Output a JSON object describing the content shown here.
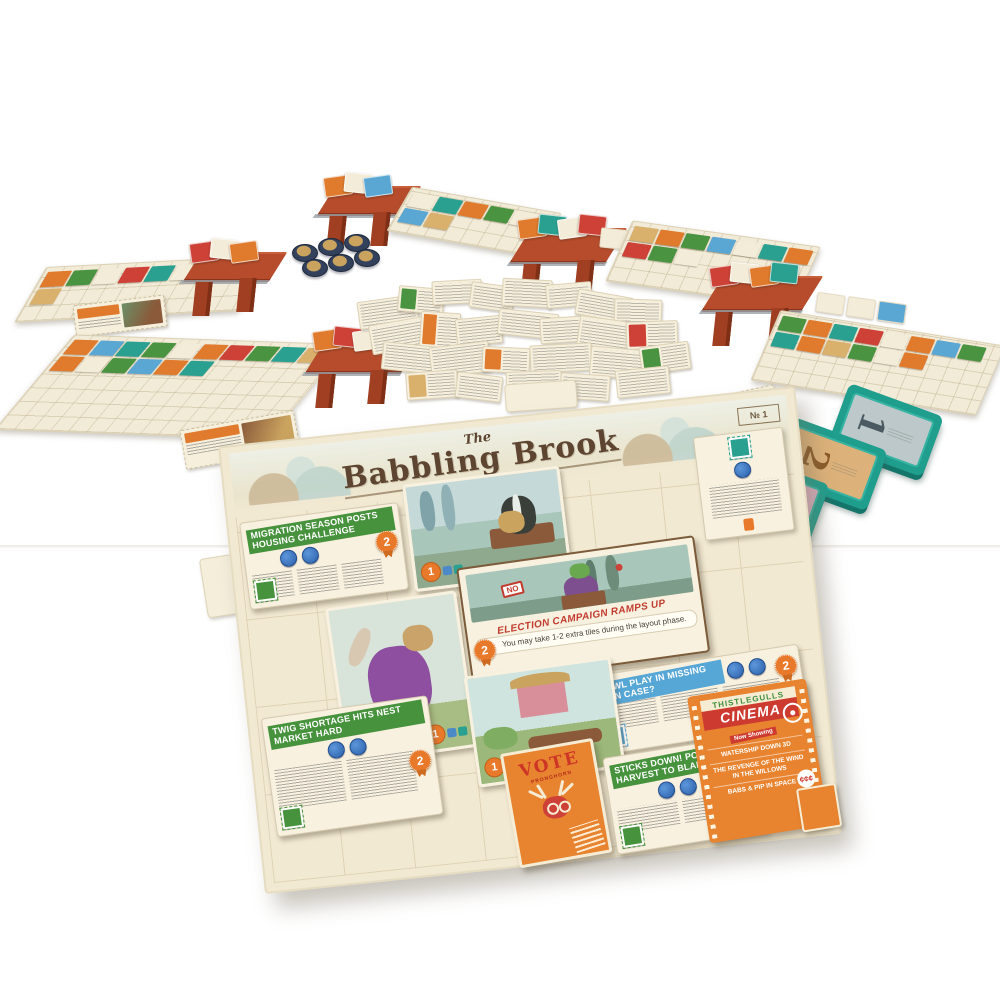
{
  "scene": {
    "description": "Product photo of the Fit to Print style newspaper board game set up on a white table",
    "board_title": "The Babbling Brook"
  },
  "palette": {
    "colors": [
      "#e07b2e",
      "#4a9340",
      "#2aa090",
      "#5aa7d4",
      "#cd4136",
      "#d9b06c",
      "#f3ecd8",
      "#8e5aa0"
    ]
  },
  "masthead": {
    "the": "The",
    "title": "Babbling Brook",
    "issue_label": "№ 1"
  },
  "central_board": {
    "headlines": [
      {
        "text": "MIGRATION SEASON POSTS HOUSING CHALLENGE",
        "color": "green"
      },
      {
        "text": "FOWL PLAY IN MISSING HEN CASE?",
        "color": "blue"
      },
      {
        "text": "TWIG SHORTAGE HITS NEST MARKET HARD",
        "color": "green"
      },
      {
        "text": "STICKS DOWN! POOR HARVEST TO BLAME",
        "color": "green"
      }
    ],
    "event_card": {
      "banner": "ELECTION CAMPAIGN RAMPS UP",
      "body": "You may take 1-2 extra tiles during the layout phase.",
      "sign_text": "NO",
      "badge": "2"
    },
    "cinema_card": {
      "venue": "THISTLEGULLS",
      "title": "CINEMA",
      "banner": "Now Showing",
      "listings": [
        "WATERSHIP DOWN 3D",
        "THE REVENGE OF THE WIND IN THE WILLOWS",
        "BABS & PIP IN SPACE"
      ],
      "cost": "¢¢¢"
    },
    "vote_card": {
      "title": "VOTE",
      "subtitle": "PRONGHORN"
    },
    "rosette_value": "2",
    "photo_badge_value": "1"
  },
  "tiles": {
    "items": [
      {
        "number": "1",
        "face": "#bcc8c9",
        "ink": "#4a5a60"
      },
      {
        "number": "2",
        "face": "#ddb27a",
        "ink": "#8a5a28"
      },
      {
        "number": "3",
        "face": "#d9b0c0",
        "ink": "#7d4f63"
      }
    ]
  },
  "tokens": {
    "positions": [
      [
        8,
        12
      ],
      [
        34,
        6
      ],
      [
        60,
        2
      ],
      [
        18,
        27
      ],
      [
        44,
        22
      ],
      [
        70,
        17
      ]
    ]
  },
  "player_areas": {
    "top_left_board": [
      0,
      1,
      6,
      4,
      2,
      6,
      1,
      0,
      5
    ],
    "left_board": [
      0,
      3,
      2,
      1,
      6,
      0,
      4,
      1,
      2,
      5,
      0,
      6,
      1,
      3,
      0,
      2
    ],
    "top_center_board": [
      6,
      2,
      0,
      1,
      6,
      3,
      5
    ],
    "right_top_board": [
      5,
      0,
      1,
      3,
      6,
      2,
      0,
      4,
      1,
      6
    ],
    "right_bottom_board": [
      1,
      0,
      2,
      4,
      6,
      0,
      3,
      1,
      2,
      0,
      5,
      1,
      6,
      0
    ],
    "heap_top_left": [
      4,
      6,
      0
    ],
    "heap_top_center_a": [
      0,
      6,
      3
    ],
    "heap_top_center_b": [
      0,
      2,
      6,
      4
    ],
    "heap_left": [
      0,
      4,
      6,
      1
    ],
    "heap_right": [
      4,
      6,
      0,
      2
    ],
    "row_right_of_stand_b": [
      6,
      5,
      6
    ],
    "row_right_of_right_stand": [
      6,
      6,
      3
    ]
  },
  "scatter": {
    "cards": [
      {
        "x": 358,
        "y": 298,
        "w": 54,
        "h": 22,
        "r": -8
      },
      {
        "x": 398,
        "y": 287,
        "w": 40,
        "h": 20,
        "r": 5,
        "a": 1
      },
      {
        "x": 432,
        "y": 280,
        "w": 44,
        "h": 18,
        "r": -3
      },
      {
        "x": 470,
        "y": 284,
        "w": 38,
        "h": 20,
        "r": 8
      },
      {
        "x": 502,
        "y": 279,
        "w": 44,
        "h": 22,
        "r": 3
      },
      {
        "x": 546,
        "y": 283,
        "w": 40,
        "h": 18,
        "r": -5
      },
      {
        "x": 576,
        "y": 293,
        "w": 50,
        "h": 20,
        "r": 10
      },
      {
        "x": 614,
        "y": 299,
        "w": 42,
        "h": 20,
        "r": 2
      },
      {
        "x": 370,
        "y": 320,
        "w": 58,
        "h": 24,
        "r": -10
      },
      {
        "x": 420,
        "y": 312,
        "w": 34,
        "h": 30,
        "r": 4,
        "a": 0
      },
      {
        "x": 456,
        "y": 317,
        "w": 40,
        "h": 22,
        "r": -6
      },
      {
        "x": 498,
        "y": 311,
        "w": 54,
        "h": 20,
        "r": 6
      },
      {
        "x": 540,
        "y": 317,
        "w": 36,
        "h": 20,
        "r": -4
      },
      {
        "x": 578,
        "y": 319,
        "w": 54,
        "h": 24,
        "r": 8
      },
      {
        "x": 626,
        "y": 321,
        "w": 46,
        "h": 22,
        "r": -2,
        "a": 4
      },
      {
        "x": 382,
        "y": 344,
        "w": 50,
        "h": 22,
        "r": 6
      },
      {
        "x": 430,
        "y": 344,
        "w": 54,
        "h": 25,
        "r": -7
      },
      {
        "x": 482,
        "y": 347,
        "w": 42,
        "h": 20,
        "r": 3,
        "a": 0
      },
      {
        "x": 530,
        "y": 344,
        "w": 56,
        "h": 22,
        "r": -3
      },
      {
        "x": 590,
        "y": 348,
        "w": 50,
        "h": 24,
        "r": 5
      },
      {
        "x": 640,
        "y": 344,
        "w": 44,
        "h": 22,
        "r": -8,
        "a": 1
      },
      {
        "x": 406,
        "y": 371,
        "w": 46,
        "h": 22,
        "r": -4,
        "a": 5
      },
      {
        "x": 456,
        "y": 374,
        "w": 40,
        "h": 20,
        "r": 7
      },
      {
        "x": 506,
        "y": 371,
        "w": 50,
        "h": 22,
        "r": -2
      },
      {
        "x": 560,
        "y": 374,
        "w": 44,
        "h": 20,
        "r": 4
      },
      {
        "x": 616,
        "y": 368,
        "w": 48,
        "h": 22,
        "r": -6
      }
    ]
  }
}
